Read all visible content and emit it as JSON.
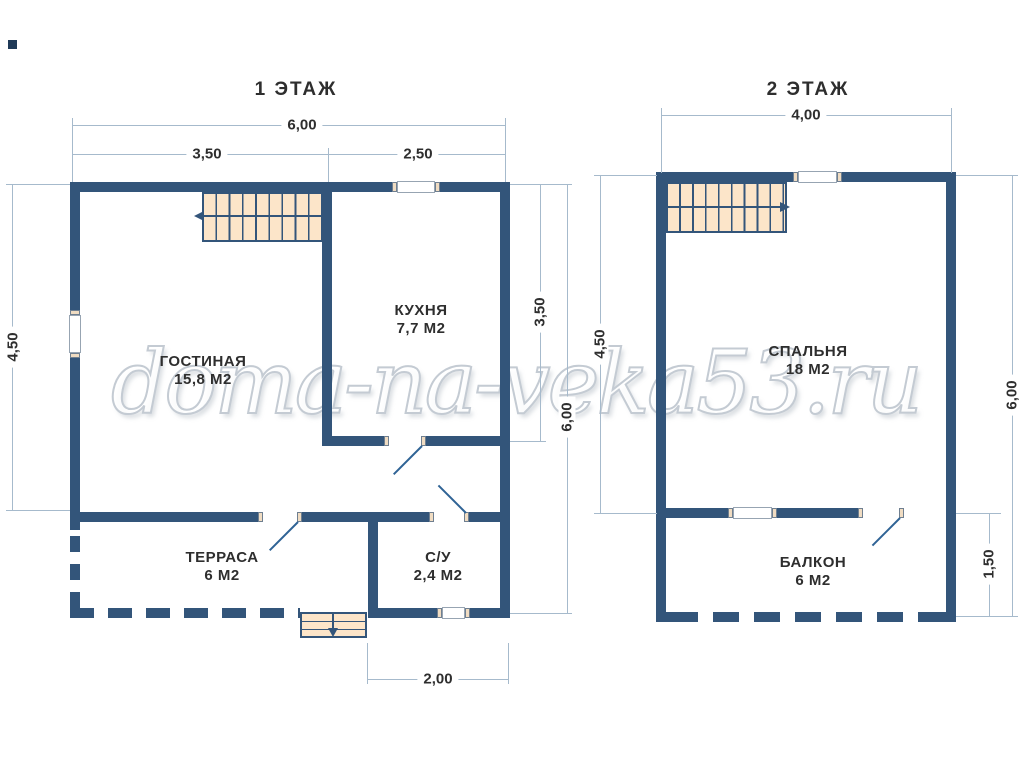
{
  "watermark_text": "doma-na-veka53.ru",
  "colors": {
    "wall": "#33557A",
    "stair_fill": "#FCE5C9",
    "door_jamb_fill": "#F0DCC2",
    "dimension_line": "#A6BACC",
    "door_swing": "#2F6395",
    "text": "#2E2E2E",
    "watermark": "#C4CBD3"
  },
  "plans": [
    {
      "title": "1 ЭТАЖ",
      "rooms": [
        {
          "name": "ГОСТИНАЯ",
          "area": "15,8 М2"
        },
        {
          "name": "КУХНЯ",
          "area": "7,7 М2"
        },
        {
          "name": "ТЕРРАСА",
          "area": "6 М2"
        },
        {
          "name": "С/У",
          "area": "2,4 М2"
        }
      ],
      "dimensions": {
        "top_total": "6,00",
        "top_left": "3,50",
        "top_right": "2,50",
        "left": "4,50",
        "right_kitchen": "3,50",
        "right_total": "6,00",
        "bottom": "2,00"
      }
    },
    {
      "title": "2 ЭТАЖ",
      "rooms": [
        {
          "name": "СПАЛЬНЯ",
          "area": "18 М2"
        },
        {
          "name": "БАЛКОН",
          "area": "6 М2"
        }
      ],
      "dimensions": {
        "top_total": "4,00",
        "left": "4,50",
        "right_balcony": "1,50",
        "right_total": "6,00"
      }
    }
  ]
}
